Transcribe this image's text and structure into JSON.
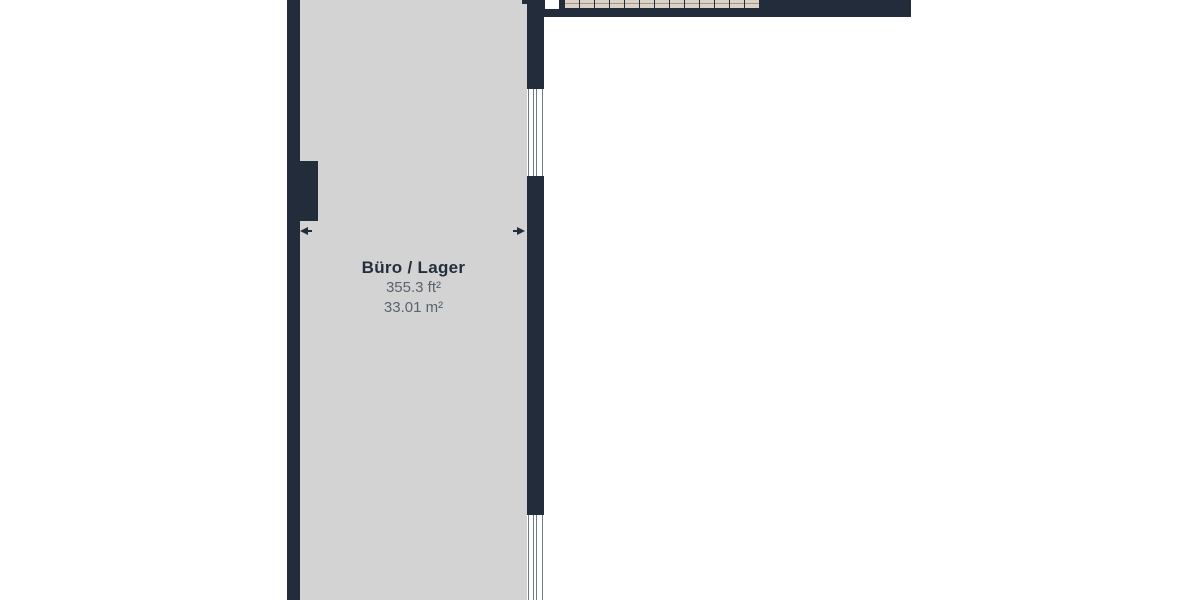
{
  "floorplan": {
    "room": {
      "name": "Büro / Lager",
      "area_ft": "355.3 ft²",
      "area_m": "33.01 m²"
    },
    "staircase": {
      "tread_count": 13
    },
    "windows": {
      "count": 2
    },
    "dimension_arrows": {
      "count": 2
    },
    "colors": {
      "wall": "#222c3a",
      "room_fill": "#d3d3d3",
      "stair_tread": "#dbd1c5",
      "room_label": "#242e3d",
      "area_text": "#5a626e",
      "window_pane_line": "#707a86",
      "canvas_background": "#ffffff"
    }
  }
}
